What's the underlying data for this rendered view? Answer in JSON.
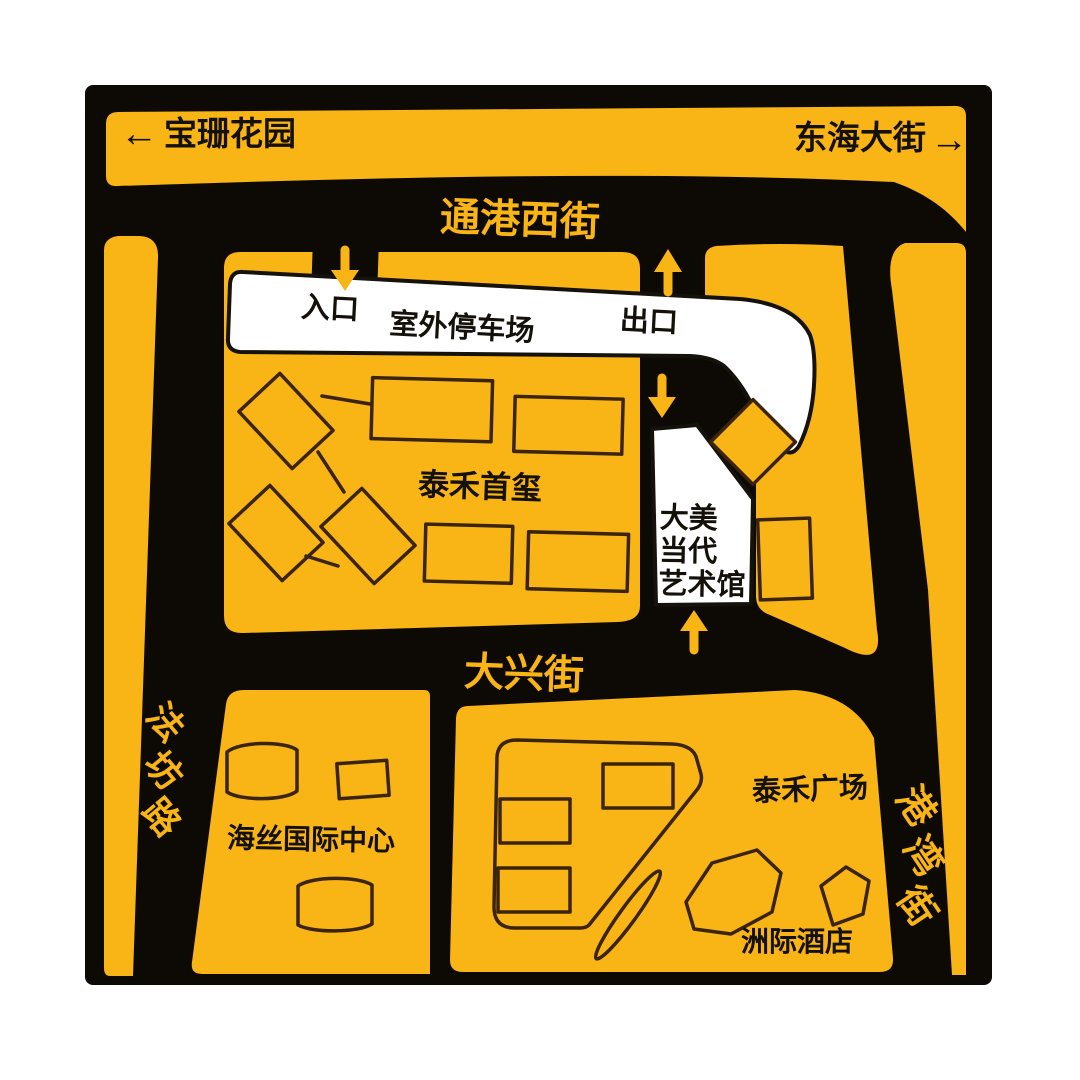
{
  "colors": {
    "yellow": "#F9B415",
    "road": "#0D0A05",
    "paper": "#FFFFFF",
    "outline": "#3A240C",
    "ink": "#14100A"
  },
  "header": {
    "left_arrow": "←",
    "left_label": "宝珊花园",
    "right_label": "东海大街",
    "right_arrow": "→"
  },
  "streets": {
    "north": "通港西街",
    "middle": "大兴街",
    "west_chars": [
      "法",
      "坊",
      "路"
    ],
    "east_chars": [
      "港",
      "湾",
      "街"
    ]
  },
  "parking": {
    "entrance_label": "入口",
    "lot_label": "室外停车场",
    "exit_label": "出口"
  },
  "places": {
    "central_block": "泰禾首玺",
    "museum_lines": [
      "大美",
      "当代",
      "艺术馆"
    ],
    "southwest_block": "海丝国际中心",
    "southeast_block": "泰禾广场",
    "hotel": "洲际酒店"
  }
}
